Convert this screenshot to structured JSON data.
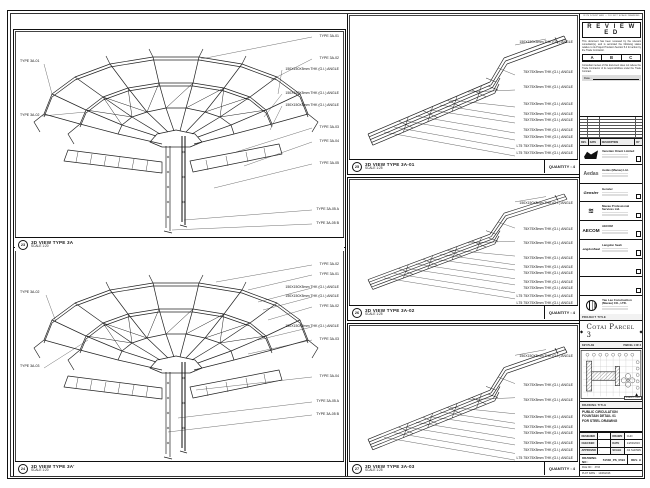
{
  "sheet": {
    "disclaimer": "IF IN DOUBT ASK — DO NOT SCALE DRAWING",
    "ink": "#1a1a1a",
    "paper": "#ffffff"
  },
  "panels": [
    {
      "bubble": "23",
      "title": "3D VIEW TYPE 3A",
      "scale": "SCALE 1:20",
      "quantity": "",
      "labels_right": [
        "TYPE 3A-01",
        "TYPE 3A-02",
        "150X150X5mm THK (G.I.) ANGLE",
        "150X150X5mm THK (G.I.) ANGLE",
        "150X150X5mm THK (G.I.) ANGLE",
        "TYPE 3A-03",
        "TYPE 3A-04",
        "TYPE 3A-05",
        "TYPE 3A-05 A",
        "TYPE 3A-05 B"
      ],
      "labels_left": [
        "TYPE 3A-01",
        "TYPE 3A-02"
      ]
    },
    {
      "bubble": "24",
      "title": "3D VIEW TYPE 3A'",
      "scale": "SCALE 1:20",
      "quantity": "",
      "labels_right": [
        "TYPE 3A-02",
        "TYPE 3A-01",
        "150X150X5mm THK (G.I.) ANGLE",
        "150X150X5mm THK (G.I.) ANGLE",
        "TYPE 3A-02",
        "150X150X5mm THK (G.I.) ANGLE",
        "TYPE 3A-03",
        "TYPE 3A-04",
        "TYPE 3A-05 A",
        "TYPE 3A-05 B"
      ],
      "labels_left": [
        "TYPE 3A-02",
        "TYPE 3A-03"
      ]
    },
    {
      "bubble": "25",
      "title": "3D VIEW TYPE 3A-01",
      "scale": "SCALE 1:25",
      "quantity": "QUANTITY : 4",
      "labels_right": [
        "150X150X5mm THK (G.I.) ANGLE",
        "75X75X5mm THK (G.I.) ANGLE",
        "75X75X5mm THK (G.I.) ANGLE",
        "75X75X5mm THK (G.I.) ANGLE",
        "75X75X5mm THK (G.I.) ANGLE",
        "75X75X5mm THK (G.I.) ANGLE",
        "75X75X5mm THK (G.I.) ANGLE",
        "75X75X5mm THK (G.I.) ANGLE",
        "L75 75X75X5mm THK (G.I.) ANGLE",
        "L75 75X75X5mm THK (G.I.) ANGLE"
      ],
      "labels_left": []
    },
    {
      "bubble": "26",
      "title": "3D VIEW TYPE 3A-02",
      "scale": "SCALE 1:25",
      "quantity": "QUANTITY : 4",
      "labels_right": [
        "150X150X5mm THK (G.I.) ANGLE",
        "75X75X5mm THK (G.I.) ANGLE",
        "75X75X5mm THK (G.I.) ANGLE",
        "75X75X5mm THK (G.I.) ANGLE",
        "75X75X5mm THK (G.I.) ANGLE",
        "75X75X5mm THK (G.I.) ANGLE",
        "75X75X5mm THK (G.I.) ANGLE",
        "75X75X5mm THK (G.I.) ANGLE",
        "L75 75X75X5mm THK (G.I.) ANGLE",
        "L75 75X75X5mm THK (G.I.) ANGLE"
      ],
      "labels_left": []
    },
    {
      "bubble": "27",
      "title": "3D VIEW TYPE 3A-03",
      "scale": "SCALE 1:25",
      "quantity": "QUANTITY : 4",
      "labels_right": [
        "150X150X5mm THK (G.I.) ANGLE",
        "75X75X5mm THK (G.I.) ANGLE",
        "75X75X5mm THK (G.I.) ANGLE",
        "75X75X5mm THK (G.I.) ANGLE",
        "75X75X5mm THK (G.I.) ANGLE",
        "75X75X5mm THK (G.I.) ANGLE",
        "75X75X5mm THK (G.I.) ANGLE",
        "75X75X5mm THK (G.I.) ANGLE",
        "L75 75X75X5mm THK (G.I.) ANGLE",
        "L75 75X75X5mm THK (G.I.) ANGLE"
      ],
      "labels_left": []
    }
  ],
  "titleblock": {
    "stamp": {
      "title": "R E V I E W E D",
      "para1": "This document has been reviewed by the relevant consultant(s), and is accorded the following status relative to its Project Provision Section 5.4 for action by the Trade Contractor.",
      "statuses": [
        "A",
        "B",
        "C"
      ],
      "para2": "Consultant review of this document does not relieve the Trade Contractor of its responsibilities under the Trade Contract.",
      "date_label": "Date :"
    },
    "revtable": {
      "headers": [
        "REV.",
        "DATE",
        "DESCRIPTION",
        "BY"
      ]
    },
    "companies": [
      {
        "logo": "",
        "name": "Venetian Orient Limited"
      },
      {
        "logo": "Aedas",
        "name": "Aedas (Macau) Ltd."
      },
      {
        "logo": "Gensler",
        "name": "Gensler"
      },
      {
        "logo": "≋",
        "name": "Macau Professional Services Ltd."
      },
      {
        "logo": "AECOM",
        "name": "AECOM"
      },
      {
        "logo": "LangdonSeah",
        "name": "Langdon Seah"
      },
      {
        "logo": "",
        "name": ""
      },
      {
        "logo": "",
        "name": ""
      },
      {
        "logo": "",
        "name": "Yau Lee Construction (Macau) CO., LTD."
      }
    ],
    "project": {
      "band": "PROJECT TITLE",
      "title": "Cotai Parcel 3",
      "ornament": "◆"
    },
    "keyplan": {
      "band": "KEY PLAN",
      "ref": "PARCEL 1 OF 3",
      "scale": "SCALE 1:2000"
    },
    "drawing": {
      "band": "DRAWING TITLE",
      "title_lines": [
        "PUBLIC CIRCULATION",
        "FOUNTAIN DETAIL 01",
        "FOR STEEL DRAWING"
      ],
      "info": [
        [
          "DESIGNED",
          "-",
          "DRAWN",
          "CHO"
        ],
        [
          "CHECKED",
          "-",
          "DATE",
          "14/03/2016"
        ],
        [
          "APPROVED",
          "-",
          "SCALE",
          "AS SHOWN"
        ]
      ],
      "number_label": "DRAWING NO :",
      "number": "51536_PS_0594",
      "rev_label": "REV.",
      "rev": "A",
      "file_label": "FILE NO :",
      "file": "3733",
      "plot_label": "PLOT DATE :",
      "plot": "14/03/2016"
    }
  }
}
